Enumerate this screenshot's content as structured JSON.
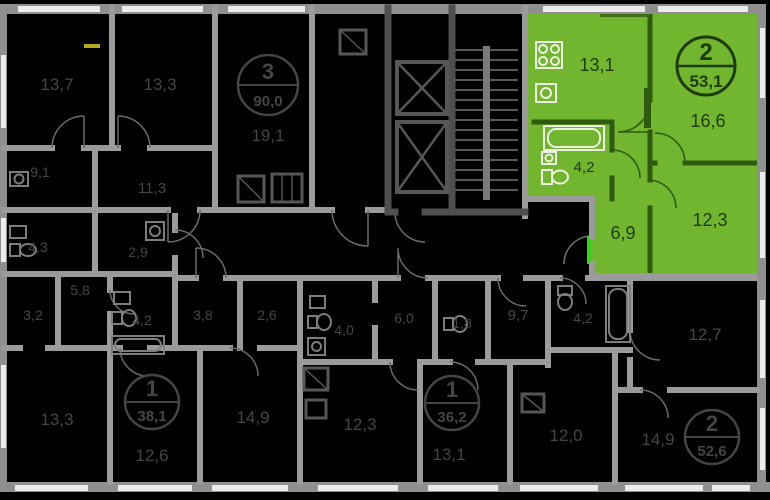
{
  "floorplan": {
    "colors": {
      "background": "#000000",
      "wall": "#9b9b9b",
      "core_wall": "#4f4f4f",
      "window": "#ececec",
      "highlight": "#72b52e",
      "highlight_wall": "#2e5b10",
      "entrance_door": "#35d41f",
      "dim_label": "#454545",
      "gas_mark": "#b3a919"
    },
    "selected_unit": {
      "rooms_count": "2",
      "total_area": "53,1",
      "kitchen_area": "13,1",
      "living_area": "16,6",
      "bath_area": "4,2",
      "hall_area": "6,9",
      "bedroom_area": "12,3"
    },
    "units": [
      {
        "rooms_count": "3",
        "total_area": "90,0",
        "living_area": "19,1"
      },
      {
        "rooms_count": "1",
        "total_area": "38,1",
        "living_area": "12,6"
      },
      {
        "rooms_count": "1",
        "total_area": "36,2",
        "living_area": "13,1"
      },
      {
        "rooms_count": "2",
        "total_area": "52,6",
        "living_area": "14,9"
      }
    ],
    "room_labels": {
      "r13_7": "13,7",
      "r13_3_top": "13,3",
      "r9_1": "9,1",
      "r11_3": "11,3",
      "r4_3": "4,3",
      "r2_9": "2,9",
      "r3_2": "3,2",
      "r5_8": "5,8",
      "r4_2_left": "4,2",
      "r3_8": "3,8",
      "r2_6": "2,6",
      "r4_0": "4,0",
      "r6_0": "6,0",
      "r1_8": "1,8",
      "r9_7": "9,7",
      "r4_2_right": "4,2",
      "r12_7": "12,7",
      "r13_3_bottom": "13,3",
      "r14_9_left": "14,9",
      "r12_3_bottom": "12,3",
      "r12_0": "12,0"
    }
  }
}
